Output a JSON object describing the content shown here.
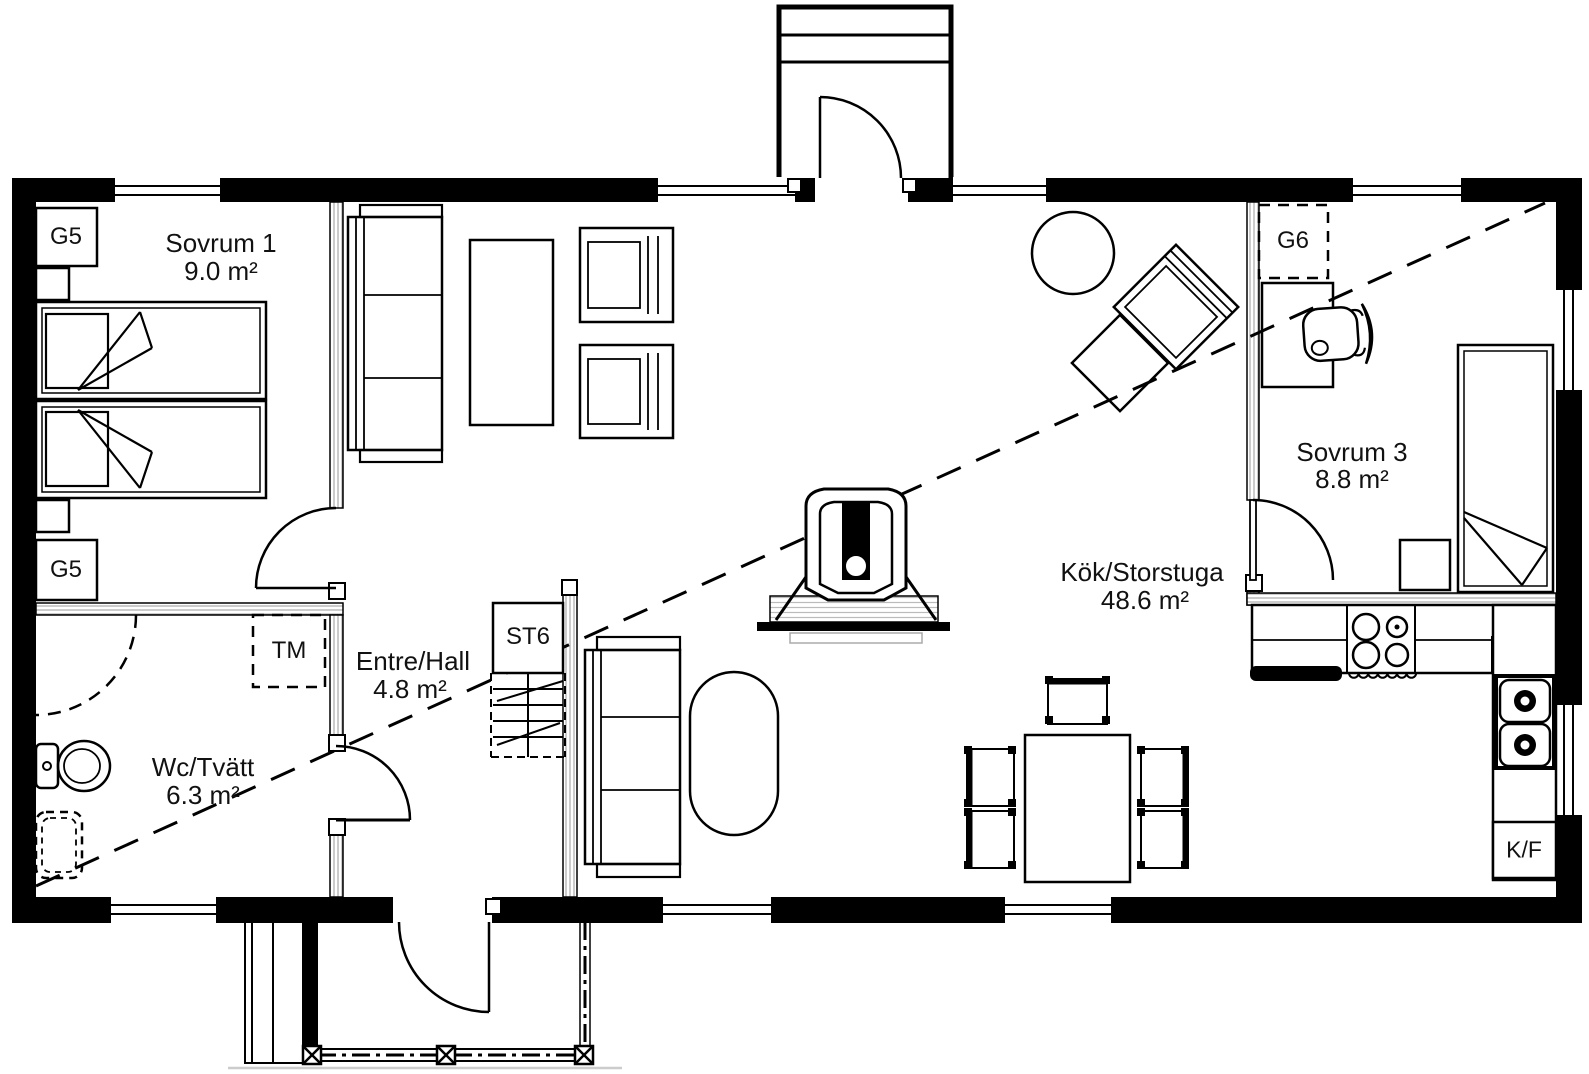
{
  "plan": {
    "type": "floor-plan",
    "rooms": [
      {
        "id": "sovrum1",
        "name": "Sovrum 1",
        "area": "9.0 m²"
      },
      {
        "id": "wc",
        "name": "Wc/Tvätt",
        "area": "6.3 m²"
      },
      {
        "id": "hall",
        "name": "Entre/Hall",
        "area": "4.8 m²"
      },
      {
        "id": "kok",
        "name": "Kök/Storstuga",
        "area": "48.6 m²"
      },
      {
        "id": "sovrum3",
        "name": "Sovrum 3",
        "area": "8.8 m²"
      }
    ],
    "labels": {
      "wardrobe_top": "G5",
      "wardrobe_bottom": "G5",
      "wardrobe_g6": "G6",
      "washing_machine": "TM",
      "stair": "ST6",
      "fridge_freezer": "K/F"
    },
    "colors": {
      "wall": "#000000",
      "line": "#000000",
      "background": "#ffffff",
      "hatch": "#999999"
    }
  }
}
